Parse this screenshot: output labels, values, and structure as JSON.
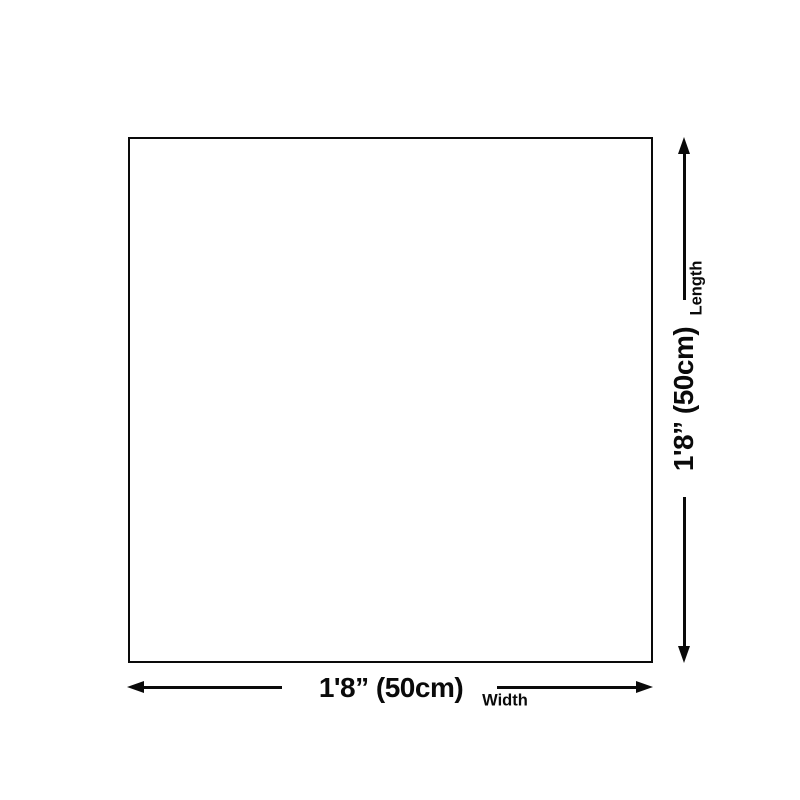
{
  "diagram": {
    "width_dimension": {
      "value": "1'8” (50cm)",
      "label": "Width"
    },
    "length_dimension": {
      "value": "1'8” (50cm)",
      "label": "Length"
    }
  },
  "colors": {
    "line": "#0a0a0a",
    "background": "#ffffff"
  }
}
